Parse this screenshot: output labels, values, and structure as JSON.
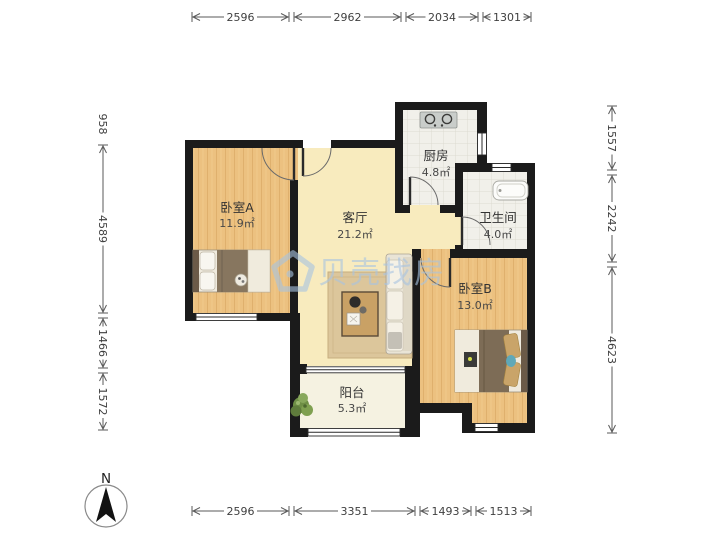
{
  "plan": {
    "type": "floor-plan",
    "watermark": {
      "brand": "贝壳找房",
      "color": "#a7c4e2",
      "logo": "shell-logo"
    },
    "compass": {
      "label": "N"
    },
    "rooms": {
      "bedroomA": {
        "name": "卧室A",
        "area": "11.9㎡"
      },
      "living": {
        "name": "客厅",
        "area": "21.2㎡"
      },
      "kitchen": {
        "name": "厨房",
        "area": "4.8㎡"
      },
      "bathroom": {
        "name": "卫生间",
        "area": "4.0㎡"
      },
      "bedroomB": {
        "name": "卧室B",
        "area": "13.0㎡"
      },
      "balcony": {
        "name": "阳台",
        "area": "5.3㎡"
      }
    },
    "dimensions": {
      "top": [
        "2596",
        "2962",
        "2034",
        "1301"
      ],
      "bottom": [
        "2596",
        "3351",
        "1493",
        "1513"
      ],
      "left": [
        "958",
        "4589",
        "1466",
        "1572"
      ],
      "right": [
        "1557",
        "2242",
        "4623"
      ]
    },
    "colors": {
      "wall": "#1b1b1b",
      "wood_floor": "#ecc180",
      "living_floor": "#f8ebbe",
      "tile_floor": "#f1f0ea",
      "balcony_floor": "#f5f2e1",
      "watermark_blue": "#a7c4e2"
    }
  }
}
